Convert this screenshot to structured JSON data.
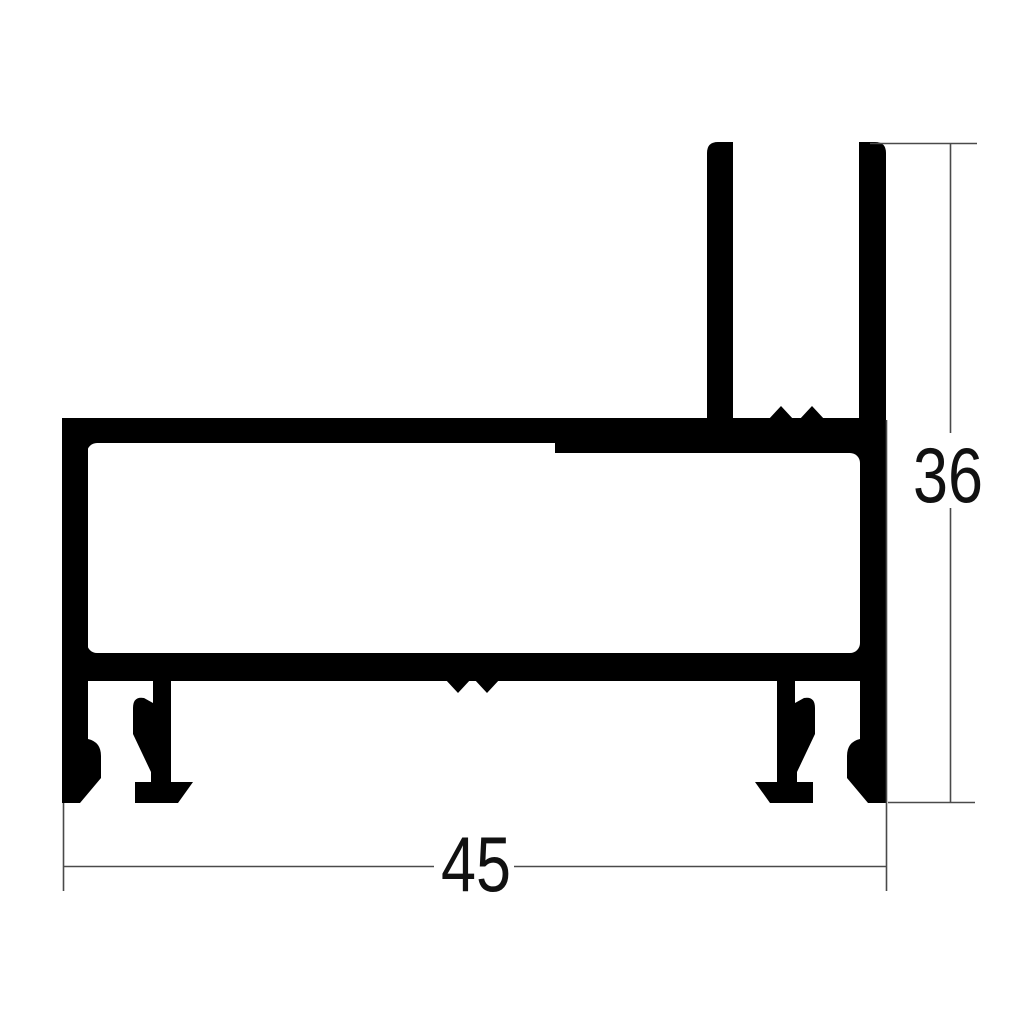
{
  "page": {
    "background_color": "#ffffff"
  },
  "drawing": {
    "type": "technical cross-section of aluminium extrusion profile",
    "profile_color": "#000000",
    "dimension_line_color": "#4a4a4a",
    "label_color": "#111111",
    "dimensions": {
      "width": {
        "label": "45"
      },
      "height": {
        "label": "36"
      }
    }
  }
}
